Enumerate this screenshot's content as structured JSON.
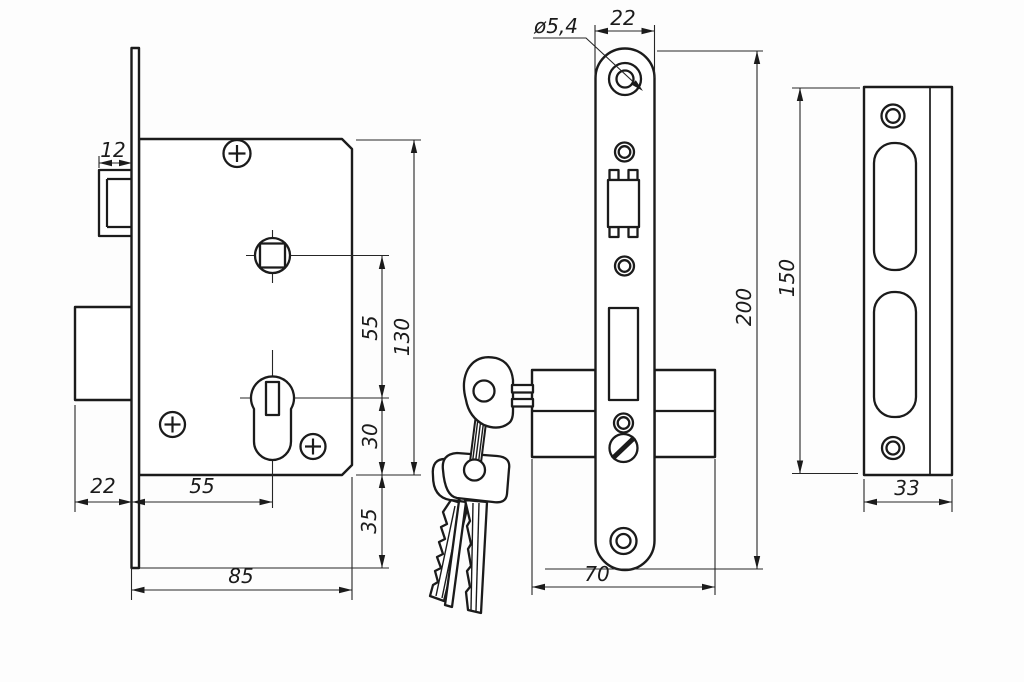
{
  "drawing": {
    "type": "technical-orthographic-views",
    "subject": "mortise-lock-with-cylinder-keys-and-strike-plate",
    "background_color": "#fdfdfd",
    "line_color": "#1b1b1b",
    "dims": {
      "latch_throw": "12",
      "deadbolt_throw": "22",
      "backset": "55",
      "case_depth": "85",
      "square_to_cylinder": "55",
      "case_height": "130",
      "cylinder_to_bottom": "30",
      "faceplate_overhang": "35",
      "screw_hole_dia": "ø5,4",
      "faceplate_width": "22",
      "faceplate_length": "200",
      "cylinder_length": "70",
      "strike_length": "150",
      "strike_width": "33"
    }
  }
}
